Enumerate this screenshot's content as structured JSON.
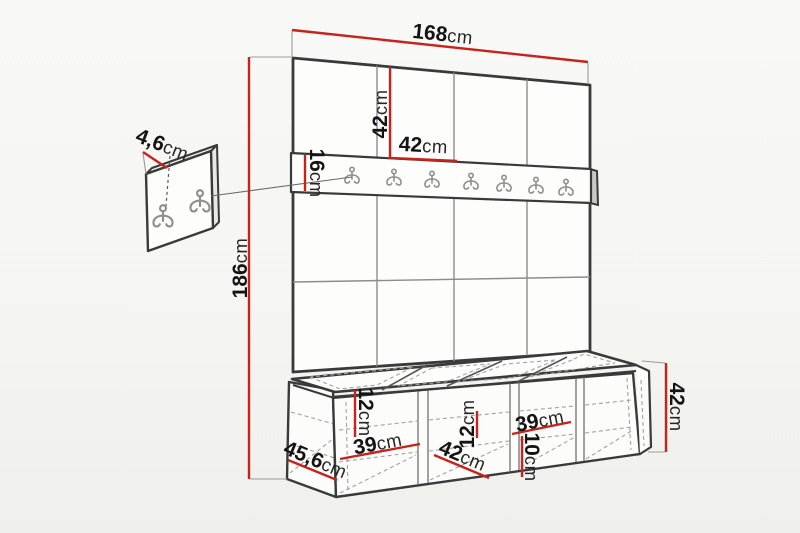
{
  "diagram": {
    "kind": "furniture-dimension-drawing",
    "subject_counts": {
      "wall_panel_columns": 4,
      "wall_panel_rows": 3,
      "rail_hooks": 7,
      "detail_panel_hooks": 2,
      "bench_sections": 4
    },
    "colors": {
      "dimension_line": "#c5231b",
      "outline": "#3a3a3a",
      "grid_line": "#8d8d8d",
      "hook": "#8f8f8e",
      "text": "#141414",
      "background": "#f5f5f3"
    },
    "dimensions": {
      "total_width": {
        "value": "168",
        "unit": "cm"
      },
      "total_height": {
        "value": "186",
        "unit": "cm"
      },
      "panel_height": {
        "value": "42",
        "unit": "cm"
      },
      "panel_width": {
        "value": "42",
        "unit": "cm"
      },
      "rail_height": {
        "value": "16",
        "unit": "cm"
      },
      "hook_panel_depth": {
        "value": "4,6",
        "unit": "cm"
      },
      "bench_left_inner_height": {
        "value": "12",
        "unit": "cm"
      },
      "bench_left_inner_width": {
        "value": "39",
        "unit": "cm"
      },
      "bench_side_depth": {
        "value": "45,6",
        "unit": "cm"
      },
      "bench_inner_depth": {
        "value": "42",
        "unit": "cm"
      },
      "bench_mid_inner_height": {
        "value": "12",
        "unit": "cm"
      },
      "bench_right_inner_width": {
        "value": "39",
        "unit": "cm"
      },
      "bench_right_inner_height": {
        "value": "10",
        "unit": "cm"
      },
      "bench_height": {
        "value": "42",
        "unit": "cm"
      }
    }
  }
}
